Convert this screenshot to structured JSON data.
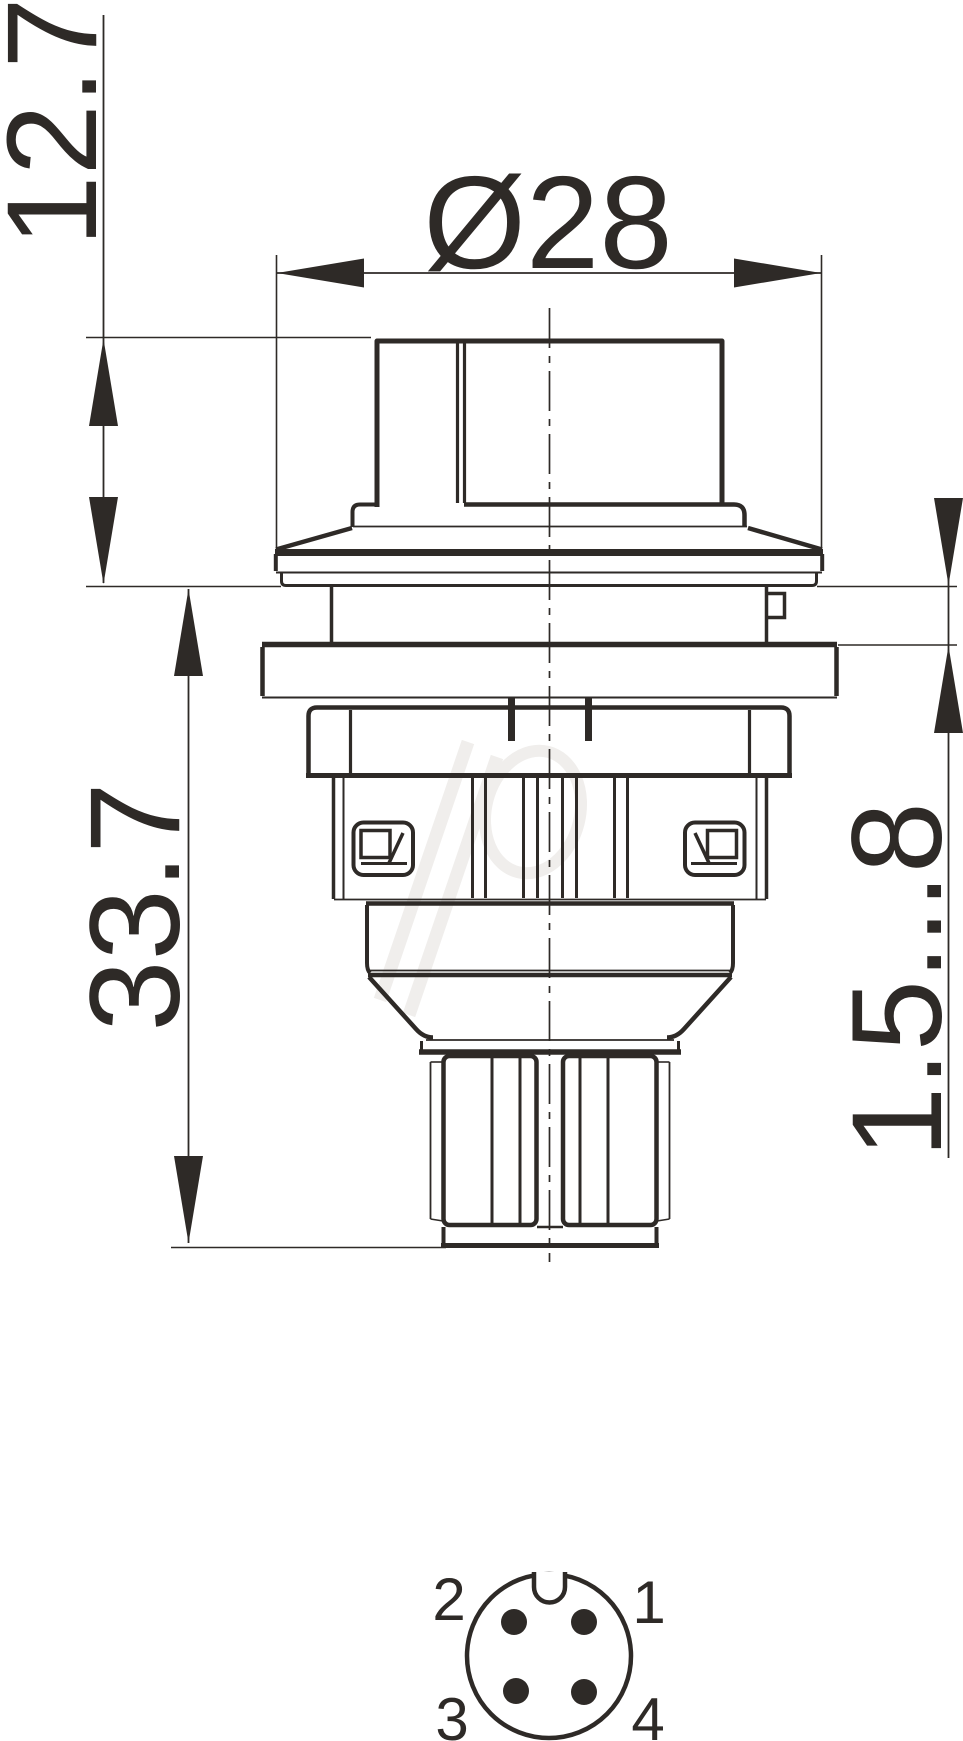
{
  "dimensions": {
    "knob_height": "12.7",
    "diameter": "Ø28",
    "total_height": "33.7",
    "panel_thickness_range": "1.5...8"
  },
  "pinout": {
    "pin_top_left": "2",
    "pin_top_right": "1",
    "pin_bottom_left": "3",
    "pin_bottom_right": "4"
  },
  "colors": {
    "line": "#2e2a27",
    "background": "#ffffff",
    "watermark": "#f0eeec"
  }
}
